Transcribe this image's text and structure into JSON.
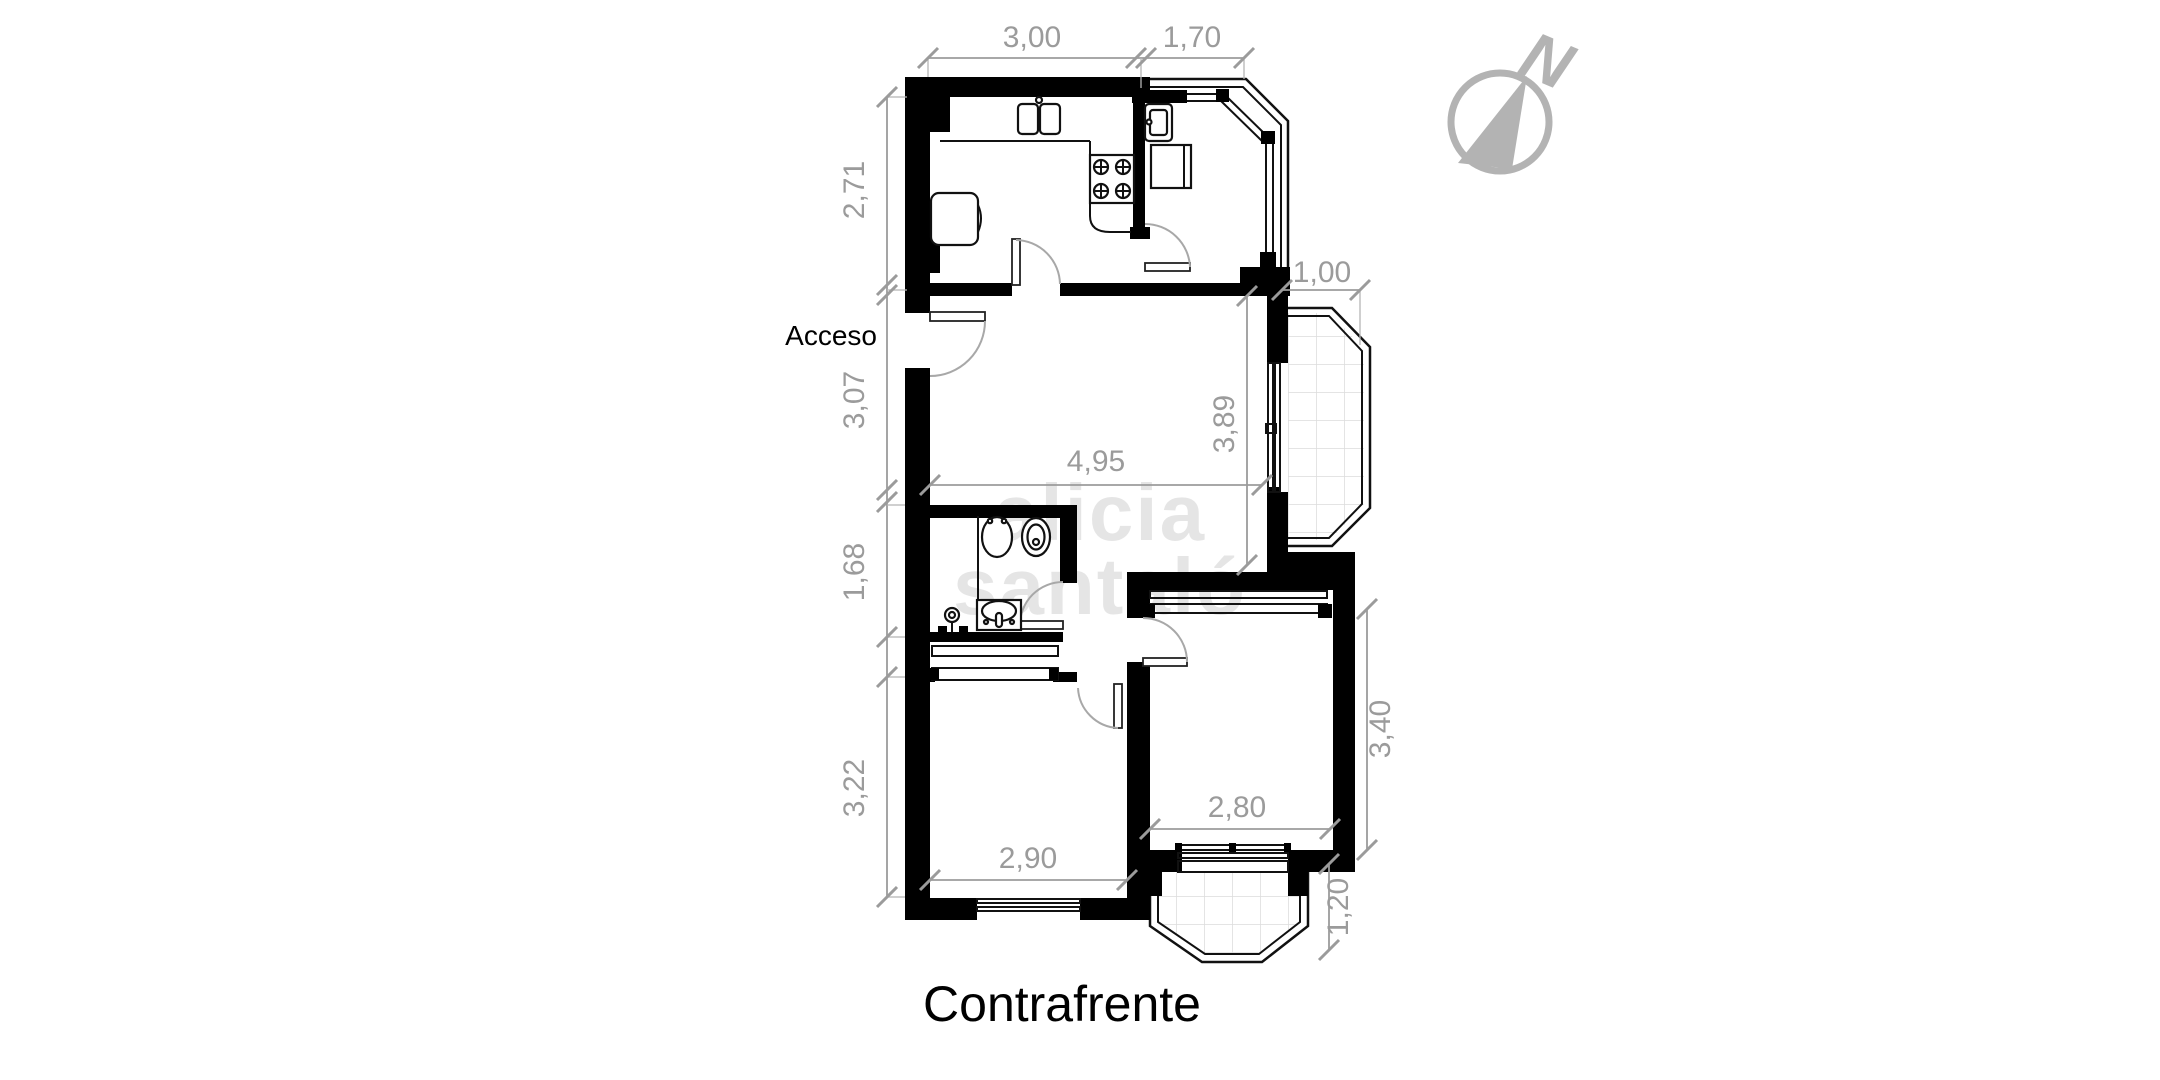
{
  "plan": {
    "access_label": "Acceso",
    "bottom_title": "Contrafrente",
    "north_label": "N"
  },
  "watermark": {
    "line1": "alicia",
    "line2": "santaló"
  },
  "dimensions": {
    "top": [
      {
        "id": "kitchen-width",
        "label": "3,00"
      },
      {
        "id": "kitchen-balcony-width",
        "label": "1,70"
      }
    ],
    "left": [
      {
        "id": "kitchen-depth",
        "label": "2,71"
      },
      {
        "id": "living-left-depth",
        "label": "3,07"
      },
      {
        "id": "bathroom-depth",
        "label": "1,68"
      },
      {
        "id": "bedroom-left-depth",
        "label": "3,22"
      }
    ],
    "inner": [
      {
        "id": "living-width",
        "label": "4,95"
      },
      {
        "id": "living-height",
        "label": "3,89"
      },
      {
        "id": "bedroom-left-width",
        "label": "2,90"
      },
      {
        "id": "bedroom-right-width",
        "label": "2,80"
      }
    ],
    "right": [
      {
        "id": "living-balcony-depth",
        "label": "1,00"
      },
      {
        "id": "bedroom-right-depth",
        "label": "3,40"
      },
      {
        "id": "bottom-balcony-depth",
        "label": "1,20"
      }
    ]
  },
  "colors": {
    "walls": "#000000",
    "dimension_gray": "#9b9b9b",
    "compass_gray": "#b3b3b3",
    "tile_gray": "#dcdcdc",
    "background": "#ffffff"
  }
}
